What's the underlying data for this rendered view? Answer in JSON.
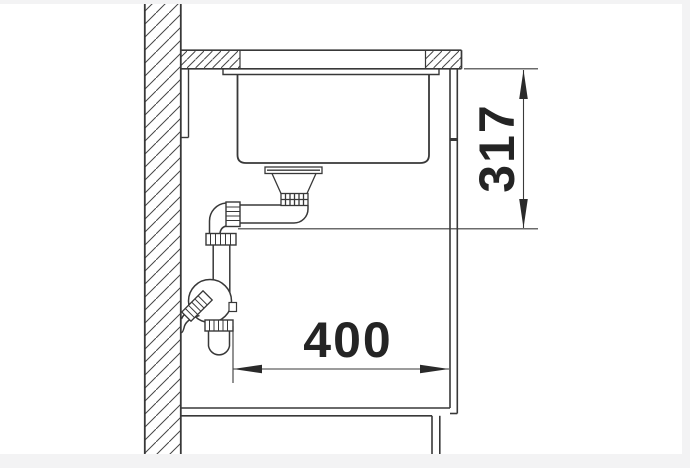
{
  "drawing": {
    "kind": "sink-undermount-installation-section",
    "dimensions": {
      "height": {
        "value": "317",
        "orientation": "vertical"
      },
      "width": {
        "value": "400",
        "orientation": "horizontal"
      }
    },
    "colors": {
      "line": "#383838",
      "text": "#242424",
      "background": "#ffffff",
      "frame": "#f3f3f4"
    }
  }
}
